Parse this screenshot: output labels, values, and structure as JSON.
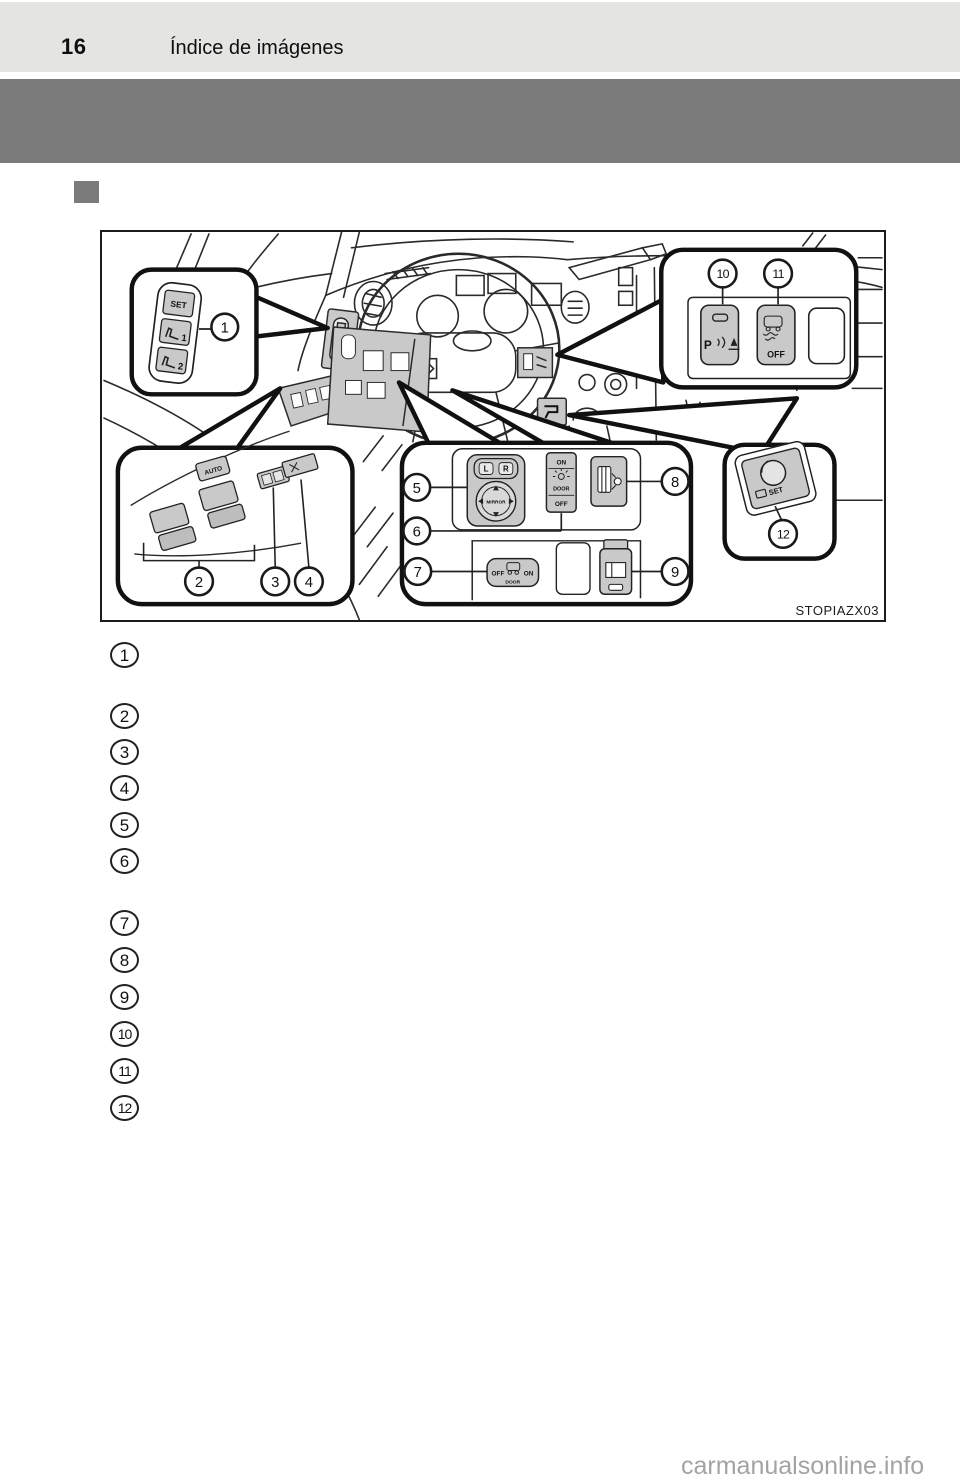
{
  "header": {
    "page_number": "16",
    "title": "Índice de imágenes"
  },
  "figure": {
    "code": "STOPIAZX03",
    "callouts": [
      "1",
      "2",
      "3",
      "4",
      "5",
      "6",
      "7",
      "8",
      "9",
      "10",
      "11",
      "12"
    ],
    "switches": {
      "seat_memory": {
        "set": "SET",
        "pos1": "1",
        "pos2": "2"
      },
      "window_master": {
        "auto": "AUTO"
      },
      "mirror": {
        "left": "L",
        "right": "R",
        "label": "MIRROR"
      },
      "room_light": {
        "on": "ON",
        "door": "DOOR",
        "off": "OFF"
      },
      "door_light": {
        "off": "OFF",
        "door": "DOOR",
        "on": "ON"
      },
      "parking_sonar": {
        "p": "P"
      },
      "vsc_off": {
        "off": "OFF"
      },
      "set_dial": {
        "set": "SET"
      }
    },
    "icons": {
      "seat-icon": "seat profile glyph",
      "lamp-icon": "sun/bulb rays",
      "truck-icon": "vehicle outline",
      "car-skid-icon": "car with skid marks",
      "sonar-icon": "P with sound waves and obstacle",
      "window-icon": "rear window pane",
      "washer-icon": "window with washer nozzle",
      "lever-icon": "release lever",
      "knob-icon": "round SET knob"
    }
  },
  "list": {
    "items": [
      {
        "number": "1"
      },
      {
        "number": "2"
      },
      {
        "number": "3"
      },
      {
        "number": "4"
      },
      {
        "number": "5"
      },
      {
        "number": "6"
      },
      {
        "number": "7"
      },
      {
        "number": "8"
      },
      {
        "number": "9"
      },
      {
        "number": "10"
      },
      {
        "number": "11"
      },
      {
        "number": "12"
      }
    ]
  },
  "watermark": {
    "text": "carmanualsonline.info"
  },
  "colors": {
    "header_band": "#e4e4e2",
    "section_band": "#7b7b7b",
    "switch_fill": "#c9c9c9",
    "line_art": "#222222",
    "watermark": "#a3a3a3"
  }
}
